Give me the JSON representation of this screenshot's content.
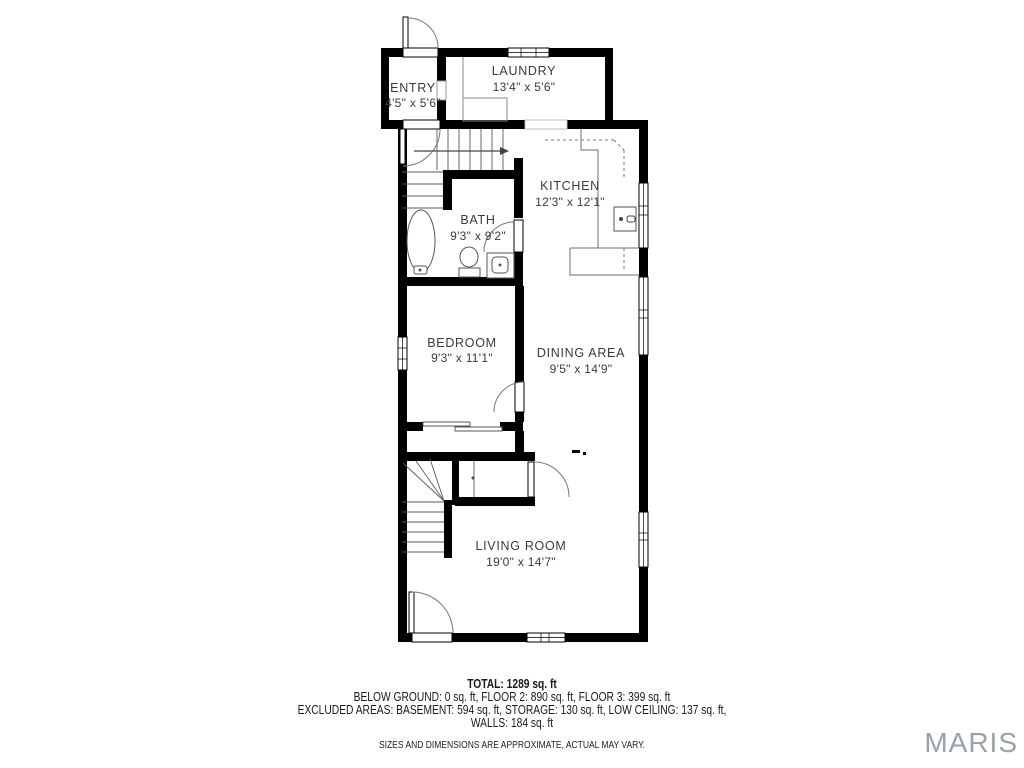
{
  "plan": {
    "rooms": [
      {
        "id": "entry",
        "name": "ENTRY",
        "dims": "4'5\" x 5'6\""
      },
      {
        "id": "laundry",
        "name": "LAUNDRY",
        "dims": "13'4\" x 5'6\""
      },
      {
        "id": "kitchen",
        "name": "KITCHEN",
        "dims": "12'3\" x 12'1\""
      },
      {
        "id": "bath",
        "name": "BATH",
        "dims": "9'3\" x 9'2\""
      },
      {
        "id": "bedroom",
        "name": "BEDROOM",
        "dims": "9'3\" x 11'1\""
      },
      {
        "id": "dining",
        "name": "DINING AREA",
        "dims": "9'5\" x 14'9\""
      },
      {
        "id": "living",
        "name": "LIVING ROOM",
        "dims": "19'0\" x 14'7\""
      }
    ]
  },
  "summary": {
    "total": "TOTAL: 1289 sq. ft",
    "floors": "BELOW GROUND: 0 sq. ft, FLOOR 2: 890 sq. ft, FLOOR 3: 399 sq. ft",
    "excluded": "EXCLUDED AREAS: BASEMENT: 594 sq. ft, STORAGE: 130 sq. ft, LOW CEILING: 137 sq. ft,",
    "walls": "WALLS: 184 sq. ft",
    "disclaimer": "SIZES AND DIMENSIONS ARE APPROXIMATE, ACTUAL MAY VARY."
  },
  "watermark": {
    "text": "MARIS",
    "color": "#9aa1a8"
  },
  "colors": {
    "walls": "#000000",
    "fixtures": "#555555",
    "labels": "#3b3b3b"
  }
}
